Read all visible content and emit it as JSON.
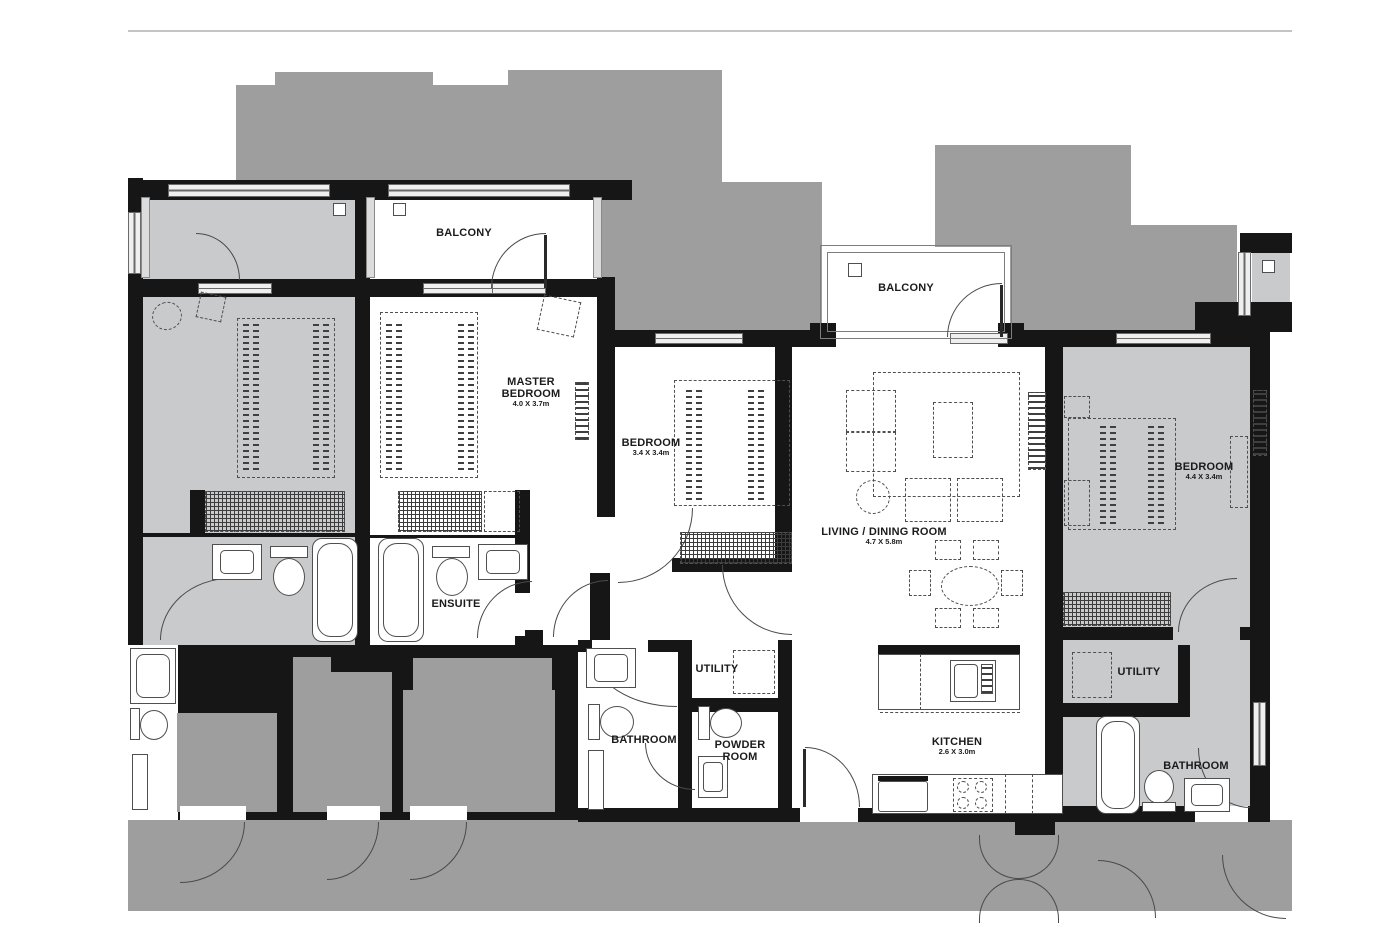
{
  "colors": {
    "wall": "#161616",
    "context_mass": "#9e9e9e",
    "corridor": "#9e9e9e",
    "neighbor_unit_fill": "#c9cacb",
    "featured_unit_fill": "#ffffff",
    "window_fill": "#efefef",
    "line": "#4a4a4a",
    "label_text": "#1b1b1b"
  },
  "rooms": {
    "balcony_left": {
      "name": "BALCONY"
    },
    "balcony_middle": {
      "name": "BALCONY"
    },
    "master_bedroom": {
      "name": "MASTER BEDROOM",
      "dims": "4.0 X 3.7m"
    },
    "bedroom_middle": {
      "name": "BEDROOM",
      "dims": "3.4 X 3.4m"
    },
    "living_dining": {
      "name": "LIVING / DINING ROOM",
      "dims": "4.7 X 5.8m"
    },
    "kitchen": {
      "name": "KITCHEN",
      "dims": "2.6 X 3.0m"
    },
    "ensuite": {
      "name": "ENSUITE"
    },
    "bathroom": {
      "name": "BATHROOM"
    },
    "utility": {
      "name": "UTILITY"
    },
    "powder_room": {
      "name": "POWDER ROOM"
    },
    "bedroom_right": {
      "name": "BEDROOM",
      "dims": "4.4 X 3.4m"
    },
    "utility_right": {
      "name": "UTILITY"
    },
    "bathroom_right": {
      "name": "BATHROOM"
    }
  }
}
